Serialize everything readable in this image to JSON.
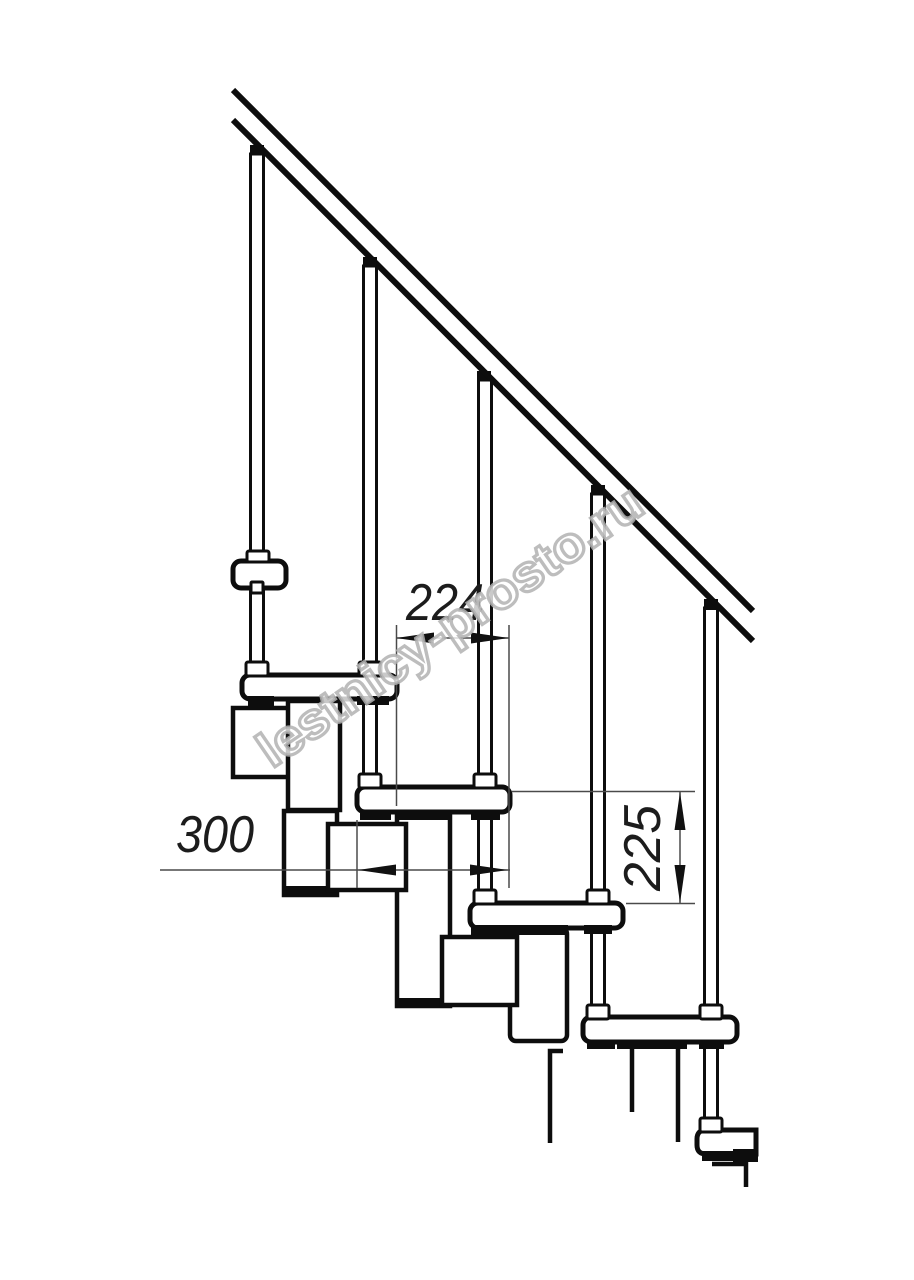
{
  "drawing": {
    "title": "Modular staircase side elevation",
    "dims": {
      "run": {
        "value": "224",
        "unit": "mm",
        "orientation": "horizontal",
        "meaning": "horizontal offset between consecutive tread edges"
      },
      "depth": {
        "value": "300",
        "unit": "mm",
        "orientation": "horizontal",
        "meaning": "tread depth"
      },
      "rise": {
        "value": "225",
        "unit": "mm",
        "orientation": "vertical",
        "meaning": "rise between consecutive treads"
      }
    },
    "watermark": {
      "text": "lestnicy-prosto.ru",
      "color": "#b2b2b2"
    },
    "colors": {
      "background": "#ffffff",
      "line": "#0d0d0d",
      "annotation_line": "#4a4a4a",
      "annotation_text": "#1c1c1c"
    }
  }
}
